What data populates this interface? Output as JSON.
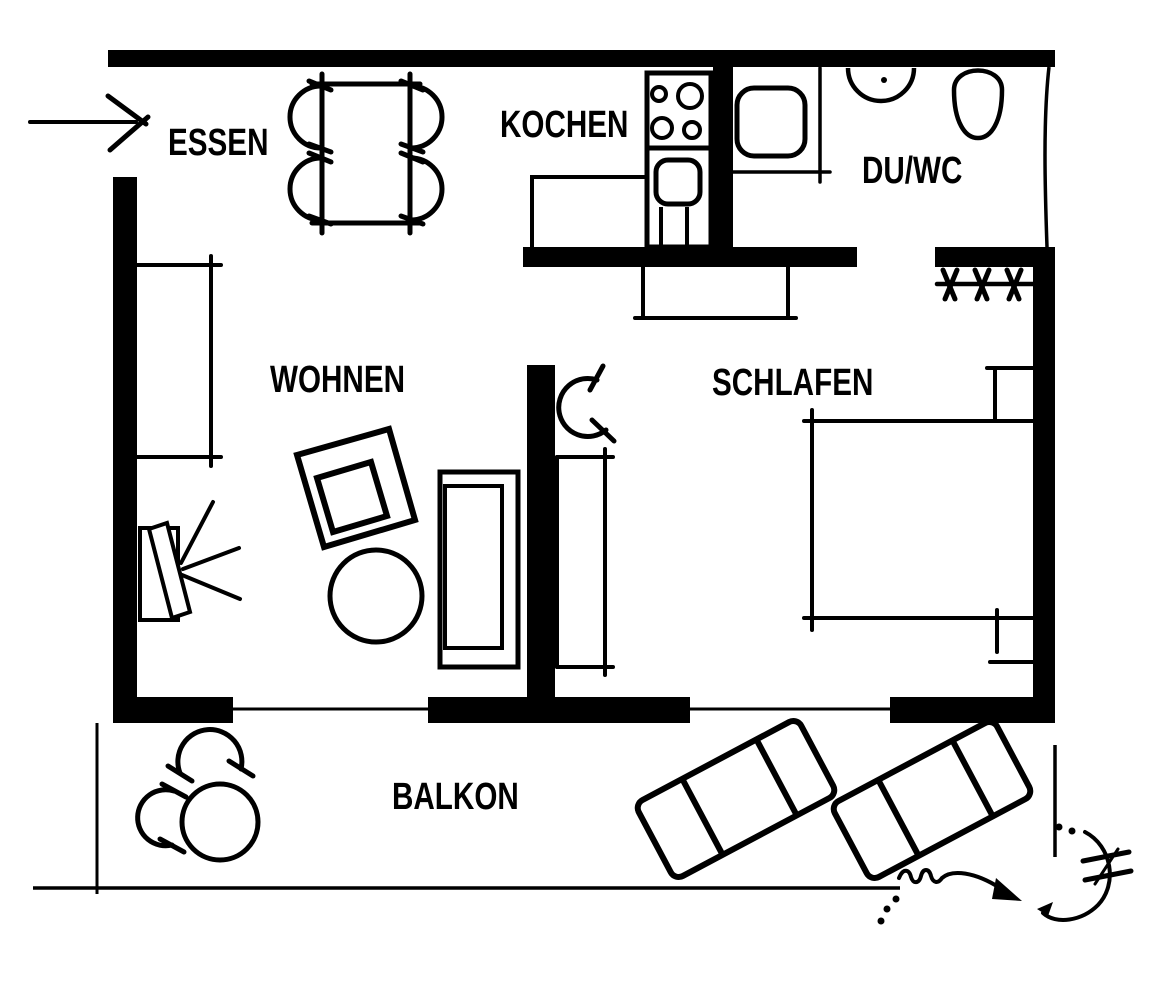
{
  "rooms": [
    {
      "id": "essen",
      "label": "ESSEN"
    },
    {
      "id": "kochen",
      "label": "KOCHEN"
    },
    {
      "id": "duwc",
      "label": "DU/WC"
    },
    {
      "id": "wohnen",
      "label": "WOHNEN"
    },
    {
      "id": "schlafen",
      "label": "SCHLAFEN"
    },
    {
      "id": "balkon",
      "label": "BALKON"
    }
  ],
  "colors": {
    "ink": "#000000",
    "paper": "#ffffff"
  },
  "furniture_icons": [
    "entry-arrow-icon",
    "dining-table-icon",
    "dining-chair-icon",
    "stove-icon",
    "kitchen-sink-icon",
    "shower-icon",
    "washbasin-icon",
    "toilet-icon",
    "coat-rack-icon",
    "sideboard-icon",
    "tv-icon",
    "armchair-icon",
    "coffee-table-icon",
    "sofa-icon",
    "door-swing-icon",
    "wardrobe-icon",
    "dresser-icon",
    "bed-icon",
    "nightstand-icon",
    "balcony-table-icon",
    "balcony-chair-icon",
    "sun-lounger-icon",
    "sketch-arrow-icon"
  ]
}
